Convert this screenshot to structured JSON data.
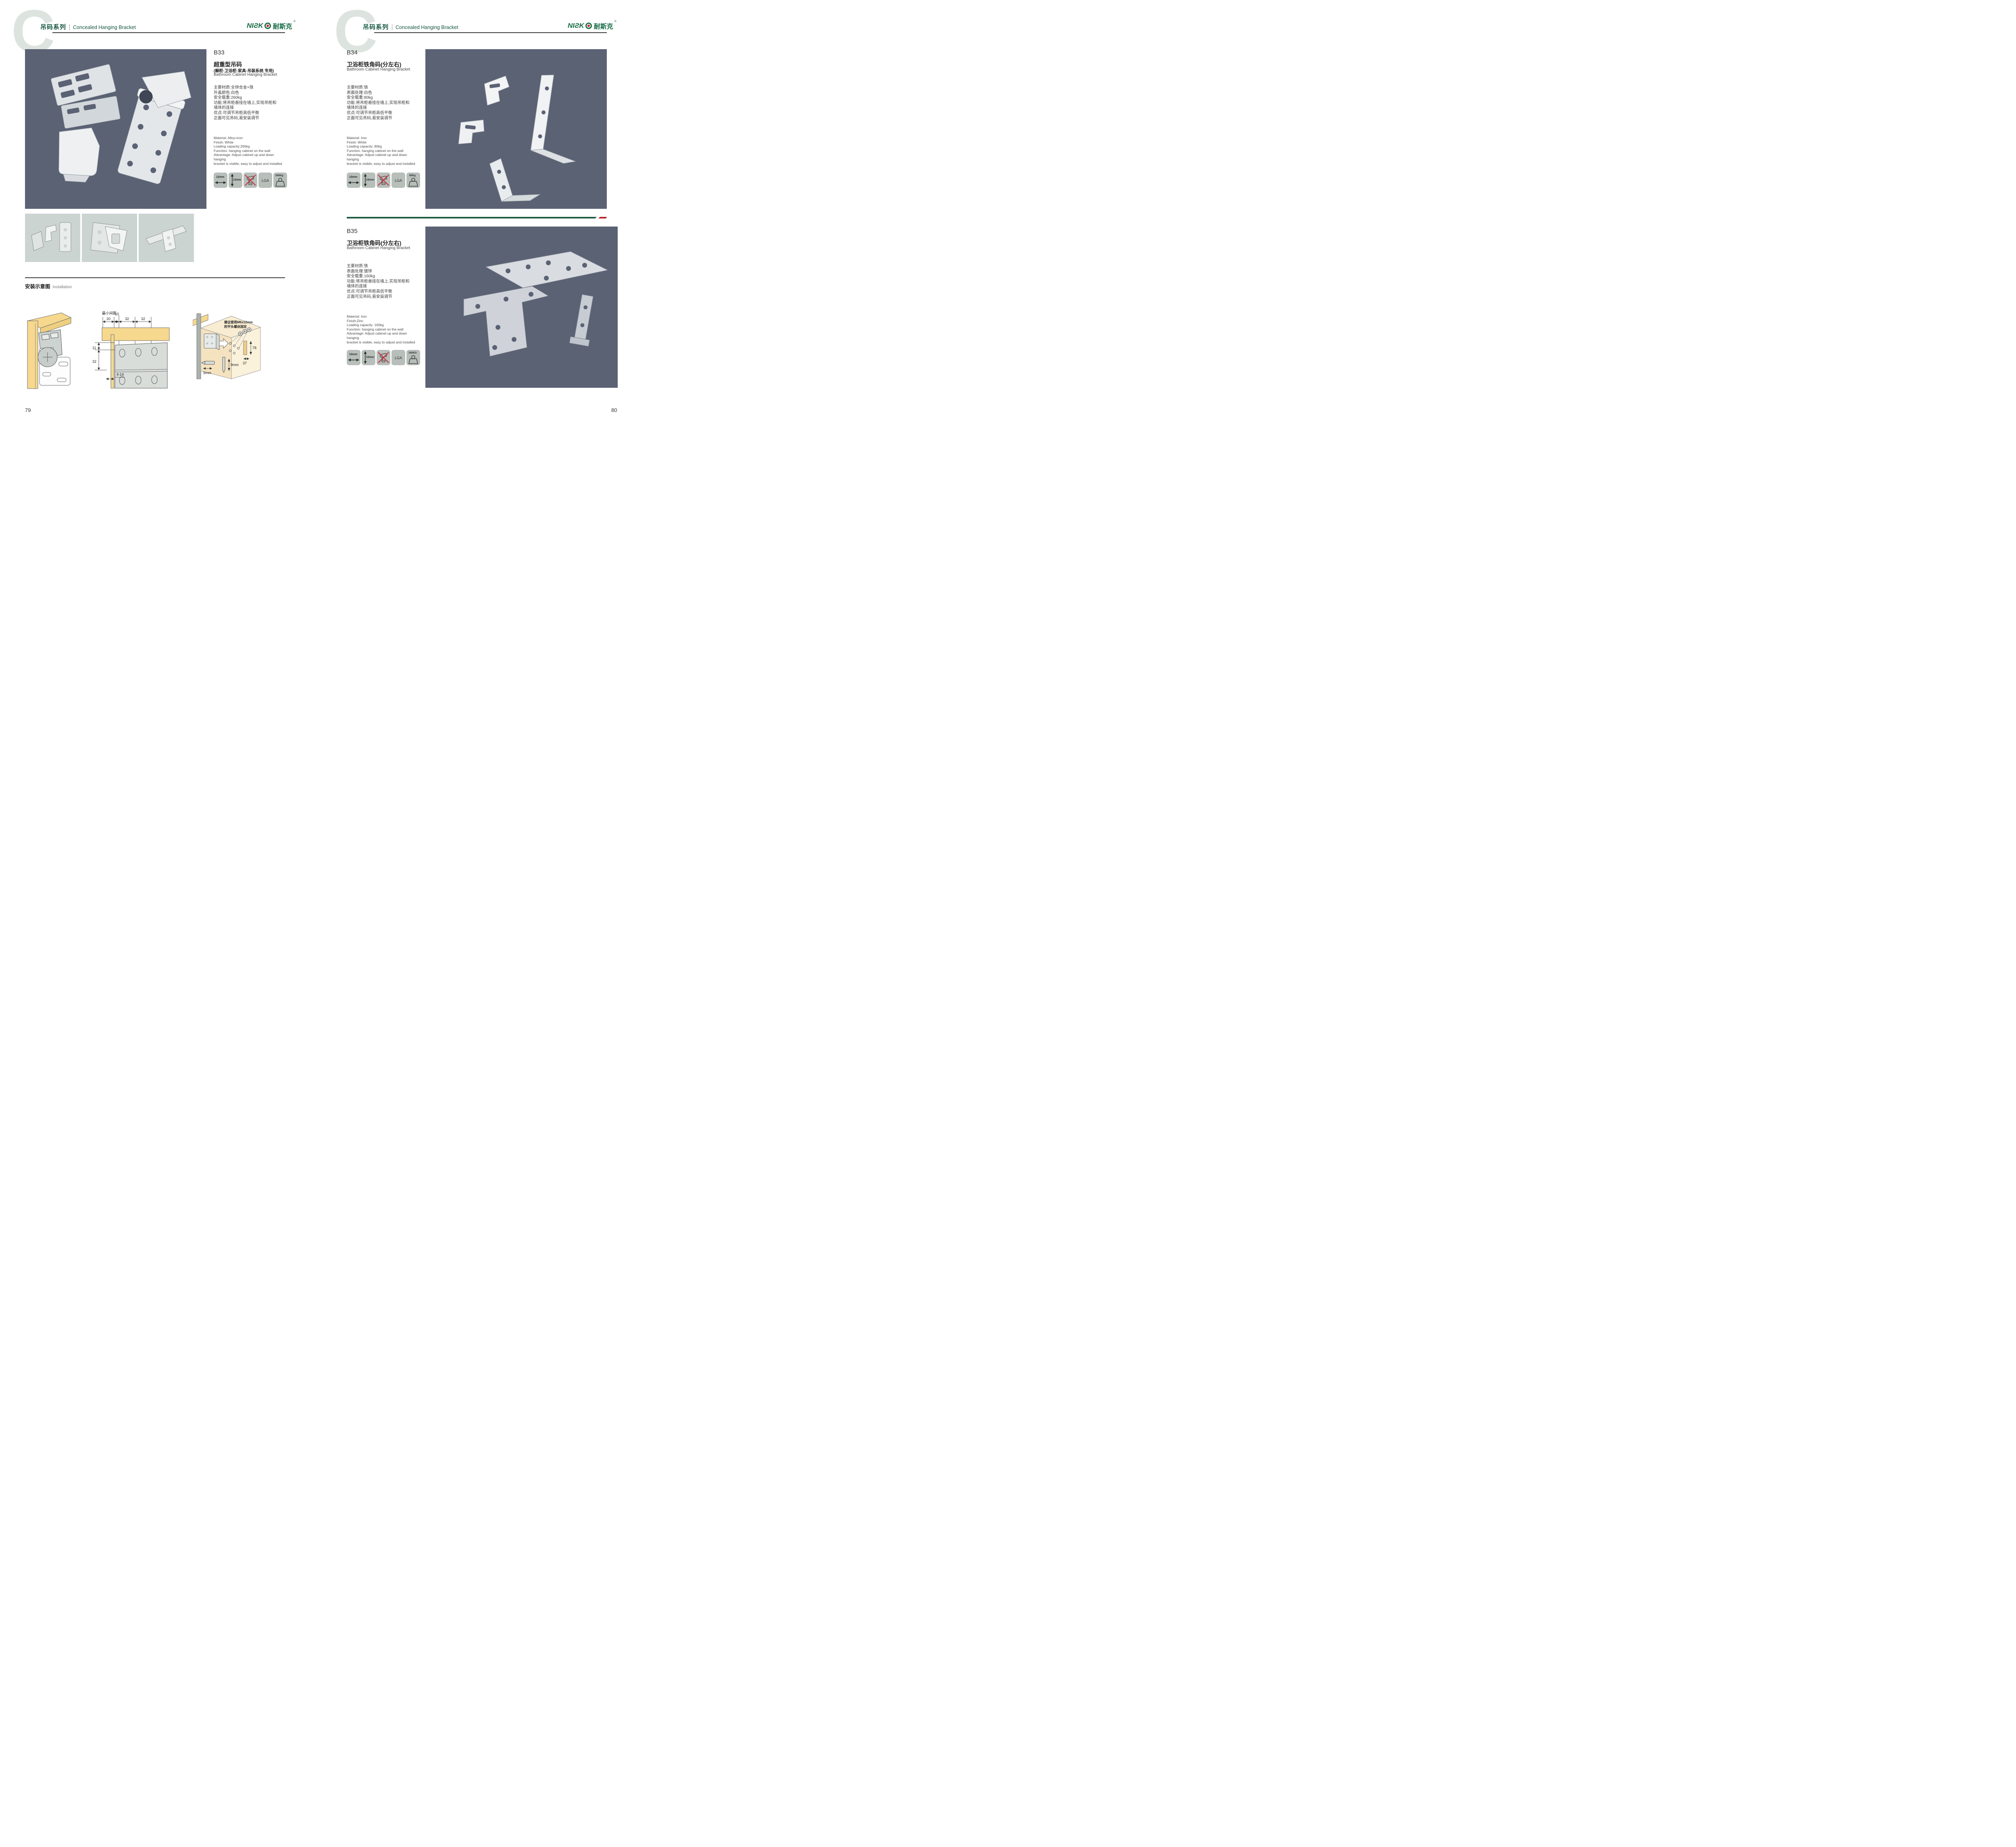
{
  "header": {
    "watermark_letter": "C",
    "series_cn": "吊码系列",
    "series_en": "Concealed Hanging Bracket"
  },
  "brand": {
    "logo_latin": "NIƧK",
    "logo_cn": "耐斯克",
    "reg": "®",
    "green": "#166b45",
    "red": "#cf2027"
  },
  "products": [
    {
      "code": "B33",
      "title_cn": "超重型吊码",
      "subtitle_cn": "(橱柜·卫浴柜·家具·吊装系统 专用)",
      "title_en": "Bathroom Cabinet Hanging Bracket",
      "specs_cn": [
        "主要材质:全锌合金+铁",
        "外盖颜色:白色",
        "安全载重:260kg",
        "功能:将吊柜悬挂在墙上,实现吊柜和",
        "墙体的连接",
        "优点:可调节吊柜高低平衡",
        "正面可见吊码,易安装调节"
      ],
      "specs_en": [
        "Material: Alloy+iron",
        "Finish: White",
        "Loading capacity:260kg",
        "Function: hanging cabinet on the wall",
        "Advantage: Adjust cabinet up and down hanging",
        "bracket is visible, easy to adjust and installed"
      ],
      "icons": {
        "width": "12mm",
        "height": "13mm",
        "cert": "LGA",
        "load": "260Kg"
      }
    },
    {
      "code": "B34",
      "title_cn": "卫浴柜铁角码(分左右)",
      "title_en": "Bathroom Cabinet Hanging Bracket",
      "specs_cn": [
        "主要材质:铁",
        "表面处理:白色",
        "安全载重:80kg",
        "功能:将吊柜悬挂在墙上,实现吊柜和",
        "墙体的连接",
        "优点:可调节吊柜高低平衡",
        "正面可见吊码,易安装调节"
      ],
      "specs_en": [
        "Material: Iron",
        "Finish: White",
        "Loading capacity: 80kg",
        "Function: hanging cabinet on the wall",
        "Advantage: Adjust cabinet up and down hanging",
        "bracket is visible, easy to adjust and installed"
      ],
      "icons": {
        "width": "10mm",
        "height": "15mm",
        "cert": "LGA",
        "load": "80Kg"
      }
    },
    {
      "code": "B35",
      "title_cn": "卫浴柜铁角码(分左右)",
      "title_en": "Bathroom Cabinet Hanging Bracket",
      "specs_cn": [
        "主要材质:铁",
        "表面处理:镀锌",
        "安全载重:160kg",
        "功能:将吊柜悬挂在墙上,实现吊柜和",
        "墙体的连接",
        "优点:可调节吊柜高低平衡",
        "正面可见吊码,易安装调节"
      ],
      "specs_en": [
        "Material: Iron",
        "Finish:Zinc",
        "Loading capacity: 160kg",
        "Function: hanging cabinet on the wall",
        "Advantage: Adjust cabinet up and down hanging",
        "bracket is visible, easy to adjust and installed"
      ],
      "icons": {
        "width": "10mm",
        "height": "15mm",
        "cert": "LGA",
        "load": "160KG"
      }
    }
  ],
  "installation": {
    "heading_cn": "安装示意图",
    "heading_en": "Installation",
    "diagram_mid": {
      "min_gap": "最小间距",
      "d20": "20",
      "d10": "10",
      "d32a": "32",
      "d32b": "32",
      "d11": "11",
      "d32c": "32",
      "d414": "4-14"
    },
    "diagram_right": {
      "note1": "建议使用M6x12mm",
      "note2": "的平头螺丝固定",
      "d78": "78",
      "d37": "37",
      "d9a": "9mm",
      "d9b": "9mm"
    }
  },
  "footer": {
    "page_left": "79",
    "page_right": "80"
  }
}
